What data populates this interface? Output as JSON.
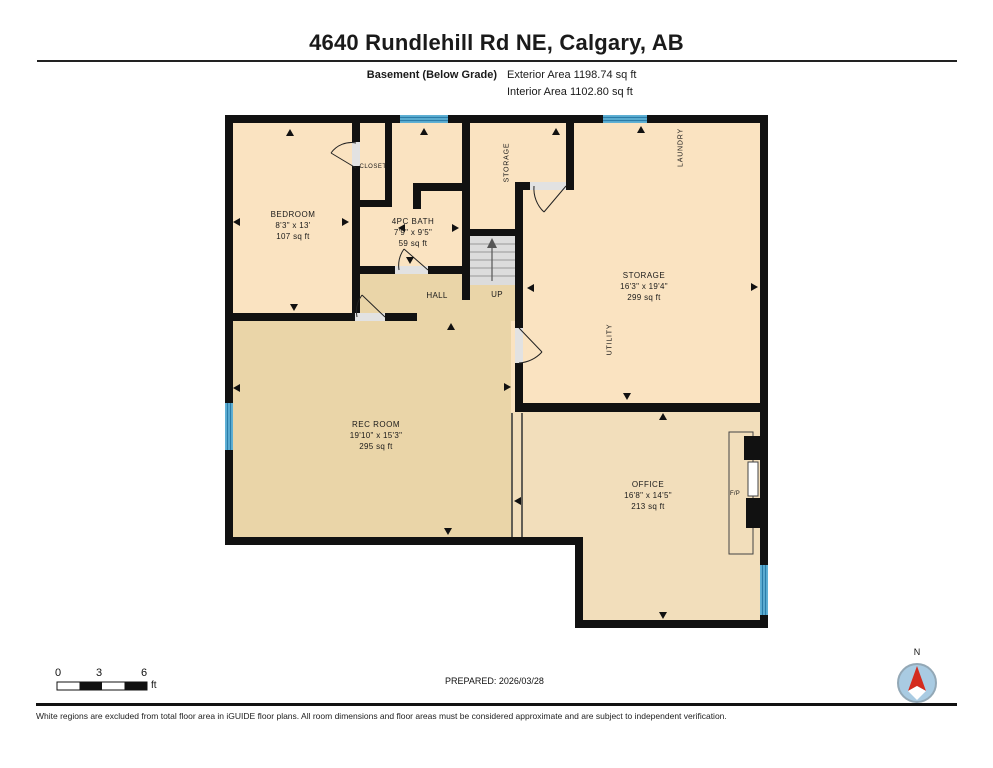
{
  "header": {
    "title": "4640 Rundlehill Rd NE, Calgary, AB",
    "floor_label": "Basement (Below Grade)",
    "exterior_area": "Exterior Area 1198.74 sq ft",
    "interior_area": "Interior Area 1102.80 sq ft"
  },
  "rooms": {
    "bedroom": {
      "name": "BEDROOM",
      "dims": "8'3\" x 13'",
      "area": "107 sq ft"
    },
    "closet": {
      "name": "CLOSET"
    },
    "bath": {
      "name": "4PC BATH",
      "dims": "7'9\" x 9'5\"",
      "area": "59 sq ft"
    },
    "storage_small": {
      "name": "STORAGE"
    },
    "laundry": {
      "name": "LAUNDRY"
    },
    "hall": {
      "name": "HALL"
    },
    "stairs": {
      "name": "UP"
    },
    "storage": {
      "name": "STORAGE",
      "dims": "16'3\" x 19'4\"",
      "area": "299 sq ft"
    },
    "utility": {
      "name": "UTILITY"
    },
    "rec_room": {
      "name": "REC ROOM",
      "dims": "19'10\" x 15'3\"",
      "area": "295 sq ft"
    },
    "office": {
      "name": "OFFICE",
      "dims": "16'8\" x 14'5\"",
      "area": "213 sq ft"
    },
    "fireplace": {
      "name": "F/P"
    }
  },
  "footer": {
    "scale": {
      "tick0": "0",
      "tick3": "3",
      "tick6": "6",
      "unit": "ft"
    },
    "prepared": "PREPARED: 2026/03/28",
    "compass": "N",
    "disclaimer": "White regions are excluded from total floor area in iGUIDE floor plans. All room dimensions and floor areas must be considered approximate and are subject to independent verification."
  },
  "colors": {
    "wall": "#111111",
    "room_light": "#FAE3C1",
    "room_mid": "#F2DEBB",
    "room_dark": "#EAD5A8",
    "window_blue": "#5FB0D4",
    "window_stripe": "#2A7CA8",
    "stairs_gray": "#DCDCDC",
    "compass_blue": "#A9CBE2",
    "north_red": "#D42B1E"
  }
}
